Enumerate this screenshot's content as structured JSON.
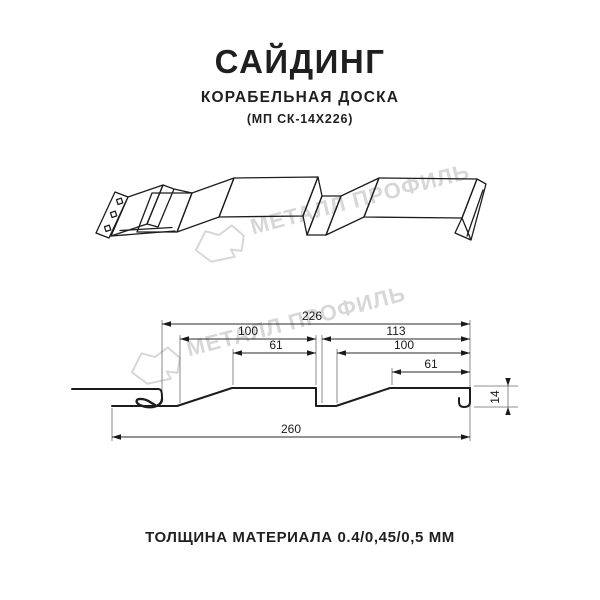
{
  "page": {
    "background": "#ffffff",
    "ink_color": "#1c1c1c",
    "watermark_color": "#d7d7d7"
  },
  "header": {
    "title": "САЙДИНГ",
    "subtitle": "КОРАБЕЛЬНАЯ ДОСКА",
    "model": "(МП СК-14Х226)"
  },
  "watermark": {
    "text": "МЕТАЛЛ ПРОФИЛЬ"
  },
  "drawing": {
    "kind": "siding-profile-cross-section",
    "dimensions_mm": {
      "overall_working_width_top": 226,
      "board1_width": 100,
      "board1_flat": 61,
      "right_section": 113,
      "board2_width": 100,
      "board2_flat": 61,
      "overall_width_bottom": 260,
      "profile_height": 14
    },
    "labels": {
      "d226": "226",
      "d100l": "100",
      "d113": "113",
      "d61l": "61",
      "d100r": "100",
      "d61r": "61",
      "d260": "260",
      "d14": "14"
    }
  },
  "footer": {
    "thickness_label": "ТОЛЩИНА МАТЕРИАЛА 0.4/0,45/0,5 ММ"
  }
}
